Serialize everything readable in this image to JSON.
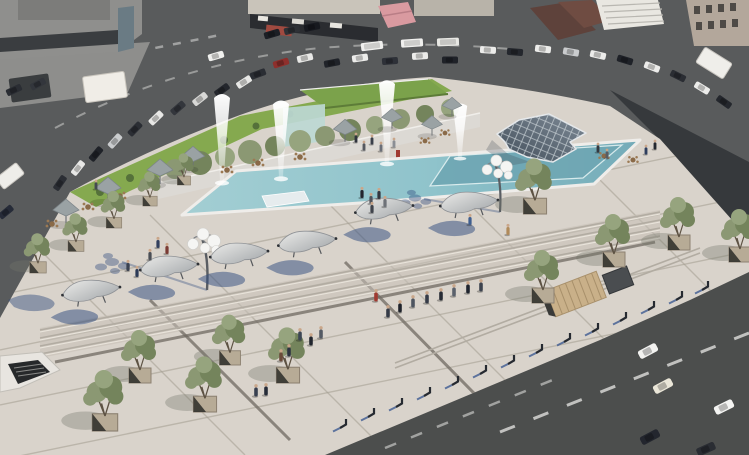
{
  "scene": {
    "title": "aerial-plaza-render",
    "description": "Aerial 3D architectural rendering of a redesigned public square: a long reflecting pool with four fountain jets, a grass-roofed glass pavilion, a low glass pyramid skylight, sculptural shade benches along wide steps, olive trees in stone planters, cafe umbrellas, globe street lamps, pedestrians, and busy streets with parked and moving cars around the plaza",
    "elements": [
      {
        "name": "reflecting-pool",
        "count": 1
      },
      {
        "name": "fountain-jet",
        "count": 4
      },
      {
        "name": "grass-roof-pavilion",
        "count": 1
      },
      {
        "name": "glass-pyramid-skylight",
        "count": 1
      },
      {
        "name": "globe-lamp",
        "count": 2
      },
      {
        "name": "sculptural-bench",
        "count": 6
      },
      {
        "name": "cafe-umbrella",
        "count": 8
      },
      {
        "name": "cafe-table",
        "count": 11
      },
      {
        "name": "olive-tree",
        "count": 15
      },
      {
        "name": "plaza-steps",
        "count": 1
      },
      {
        "name": "timber-ramp",
        "count": 1
      },
      {
        "name": "bollard",
        "count": 14
      },
      {
        "name": "pedestrian",
        "count": 38
      },
      {
        "name": "vehicle",
        "count": 40
      },
      {
        "name": "building-block",
        "count": 6
      },
      {
        "name": "subway-entrance",
        "count": 1
      }
    ]
  },
  "palette": {
    "plaza": "#d9d3cb",
    "plaza_shade": "#c6c0b7",
    "joint": "#a39c90",
    "joint_dark": "#6f6a61",
    "asphalt": "#595b5c",
    "asphalt_dark": "#36393c",
    "road": "#4c4e4d",
    "marking": "#e8e8e6",
    "pool_water": "#9ccad0",
    "pool_deep": "#6fa7b4",
    "coping": "#efedea",
    "lawn": "#85a94f",
    "lawn_dark": "#55713a",
    "roof_green": "#7ba24b",
    "foliage": "#8b9873",
    "foliage_dark": "#74845c",
    "foliage_light": "#96a47e",
    "trunk": "#5d5243",
    "planter": "#b7ab96",
    "wall": "#dcd9d4",
    "glass": "#bdd8d4",
    "pyramid_hi": "#7e8a96",
    "pyramid_lo": "#434f5b",
    "umbrella": "#9aa2a4",
    "seat_light": "#e9e9e7",
    "seat_dark": "#a4a8ab",
    "shadow": "#2e4a7d",
    "wood": "#c9b089",
    "skin": "#c9a68a",
    "red_accent": "#a03a31"
  }
}
